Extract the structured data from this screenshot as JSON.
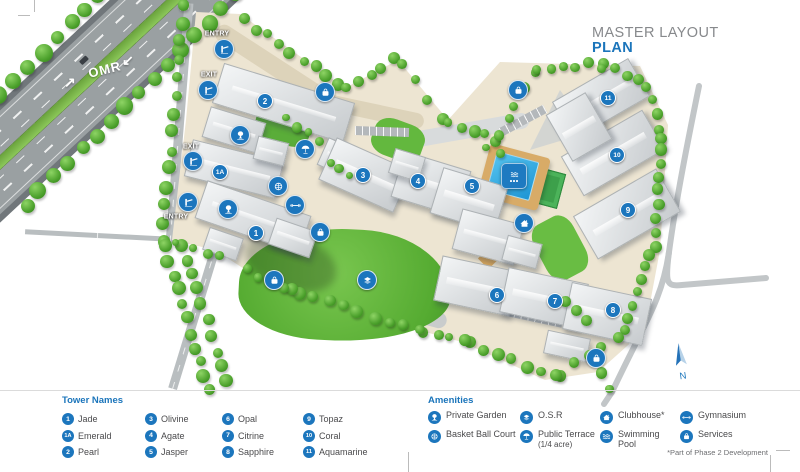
{
  "title": {
    "line1": "MASTER LAYOUT",
    "line2": "PLAN"
  },
  "map": {
    "road_label": "OMR",
    "north_label": "N",
    "gates": [
      {
        "label": "ENTRY",
        "icon_x": 224,
        "icon_y": 49,
        "label_x": 217,
        "label_y": 34
      },
      {
        "label": "EXIT",
        "icon_x": 208,
        "icon_y": 90,
        "label_x": 209,
        "label_y": 75
      },
      {
        "label": "EXIT",
        "icon_x": 193,
        "icon_y": 161,
        "label_x": 191,
        "label_y": 147
      },
      {
        "label": "ENTRY",
        "icon_x": 188,
        "icon_y": 202,
        "label_x": 176,
        "label_y": 217
      }
    ],
    "towers": [
      {
        "id": "1",
        "x": 256,
        "y": 233
      },
      {
        "id": "1A",
        "x": 220,
        "y": 172
      },
      {
        "id": "2",
        "x": 265,
        "y": 101
      },
      {
        "id": "3",
        "x": 363,
        "y": 175
      },
      {
        "id": "4",
        "x": 418,
        "y": 181
      },
      {
        "id": "5",
        "x": 472,
        "y": 186
      },
      {
        "id": "6",
        "x": 497,
        "y": 295
      },
      {
        "id": "7",
        "x": 555,
        "y": 301
      },
      {
        "id": "8",
        "x": 613,
        "y": 310
      },
      {
        "id": "9",
        "x": 628,
        "y": 210
      },
      {
        "id": "10",
        "x": 617,
        "y": 155
      },
      {
        "id": "11",
        "x": 608,
        "y": 98
      }
    ],
    "amenity_markers": [
      {
        "type": "private-garden",
        "x": 240,
        "y": 135
      },
      {
        "type": "private-garden",
        "x": 228,
        "y": 209
      },
      {
        "type": "public-terrace",
        "x": 305,
        "y": 149
      },
      {
        "type": "basket-ball-court",
        "x": 278,
        "y": 186
      },
      {
        "type": "gymnasium",
        "x": 295,
        "y": 205
      },
      {
        "type": "services",
        "x": 325,
        "y": 92
      },
      {
        "type": "services",
        "x": 518,
        "y": 90
      },
      {
        "type": "services",
        "x": 320,
        "y": 232
      },
      {
        "type": "services",
        "x": 274,
        "y": 280
      },
      {
        "type": "services",
        "x": 596,
        "y": 358
      },
      {
        "type": "osr",
        "x": 367,
        "y": 280
      },
      {
        "type": "clubhouse",
        "x": 524,
        "y": 223
      },
      {
        "type": "swimming-pool",
        "x": 514,
        "y": 176,
        "badge": true
      }
    ]
  },
  "legend": {
    "towers": {
      "title": "Tower Names",
      "items": [
        {
          "id": "1",
          "name": "Jade"
        },
        {
          "id": "1A",
          "name": "Emerald"
        },
        {
          "id": "2",
          "name": "Pearl"
        },
        {
          "id": "3",
          "name": "Olivine"
        },
        {
          "id": "4",
          "name": "Agate"
        },
        {
          "id": "5",
          "name": "Jasper"
        },
        {
          "id": "6",
          "name": "Opal"
        },
        {
          "id": "7",
          "name": "Citrine"
        },
        {
          "id": "8",
          "name": "Sapphire"
        },
        {
          "id": "9",
          "name": "Topaz"
        },
        {
          "id": "10",
          "name": "Coral"
        },
        {
          "id": "11",
          "name": "Aquamarine"
        }
      ]
    },
    "amenities": {
      "title": "Amenities",
      "items": [
        {
          "icon": "private-garden",
          "name": "Private Garden"
        },
        {
          "icon": "basket-ball-court",
          "name": "Basket Ball Court"
        },
        {
          "icon": "osr",
          "name": "O.S.R"
        },
        {
          "icon": "public-terrace",
          "name": "Public Terrace",
          "sub": "(1/4 acre)"
        },
        {
          "icon": "clubhouse",
          "name": "Clubhouse*"
        },
        {
          "icon": "swimming-pool",
          "name": "Swimming Pool"
        },
        {
          "icon": "gymnasium",
          "name": "Gymnasium"
        },
        {
          "icon": "services",
          "name": "Services"
        }
      ]
    },
    "footnote": "*Part of Phase 2 Development"
  },
  "colors": {
    "accent": "#1b75bc",
    "title_gray": "#87898c",
    "legend_text": "#4a4a4c",
    "road_gray": "#9aa0a2",
    "lawn_green": "#61b83c",
    "pool_blue": "#2ea8e0"
  }
}
